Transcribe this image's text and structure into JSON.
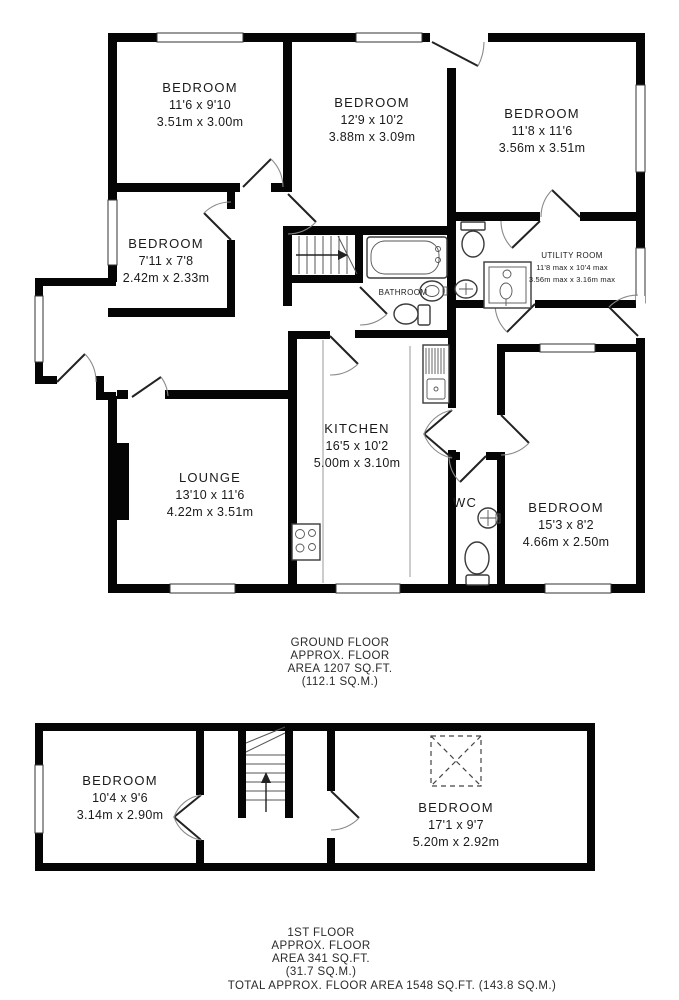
{
  "ground_floor": {
    "rooms": [
      {
        "name": "BEDROOM",
        "imperial": "11'6 x 9'10",
        "metric": "3.51m x 3.00m"
      },
      {
        "name": "BEDROOM",
        "imperial": "12'9 x 10'2",
        "metric": "3.88m x 3.09m"
      },
      {
        "name": "BEDROOM",
        "imperial": "11'8 x 11'6",
        "metric": "3.56m x 3.51m"
      },
      {
        "name": "BEDROOM",
        "imperial": "7'11 x 7'8",
        "metric": "2.42m x 2.33m"
      },
      {
        "name": "UTILITY ROOM",
        "imperial": "11'8 max x 10'4 max",
        "metric": "3.56m max x 3.16m max"
      },
      {
        "name": "BATHROOM"
      },
      {
        "name": "KITCHEN",
        "imperial": "16'5 x 10'2",
        "metric": "5.00m x 3.10m"
      },
      {
        "name": "WC"
      },
      {
        "name": "LOUNGE",
        "imperial": "13'10 x 11'6",
        "metric": "4.22m x 3.51m"
      },
      {
        "name": "BEDROOM",
        "imperial": "15'3 x 8'2",
        "metric": "4.66m x 2.50m"
      }
    ],
    "caption": {
      "line1": "GROUND FLOOR",
      "line2": "APPROX. FLOOR",
      "line3": "AREA 1207 SQ.FT.",
      "line4": "(112.1 SQ.M.)"
    }
  },
  "first_floor": {
    "rooms": [
      {
        "name": "BEDROOM",
        "imperial": "10'4 x 9'6",
        "metric": "3.14m x 2.90m"
      },
      {
        "name": "BEDROOM",
        "imperial": "17'1 x 9'7",
        "metric": "5.20m x 2.92m"
      }
    ],
    "caption": {
      "line1": "1ST FLOOR",
      "line2": "APPROX. FLOOR",
      "line3": "AREA 341 SQ.FT.",
      "line4": "(31.7 SQ.M.)"
    }
  },
  "total_caption": "TOTAL APPROX. FLOOR AREA 1548 SQ.FT. (143.8 SQ.M.)",
  "colors": {
    "wall": "#050505",
    "background": "#ffffff",
    "text": "#1a1a1a"
  },
  "icons": [
    "stairs-icon",
    "bathtub-icon",
    "toilet-icon",
    "sink-icon",
    "shower-tray-icon",
    "stove-icon",
    "kitchen-sink-icon",
    "loft-restricted-height-icon",
    "door-swing-icon",
    "window-icon"
  ]
}
